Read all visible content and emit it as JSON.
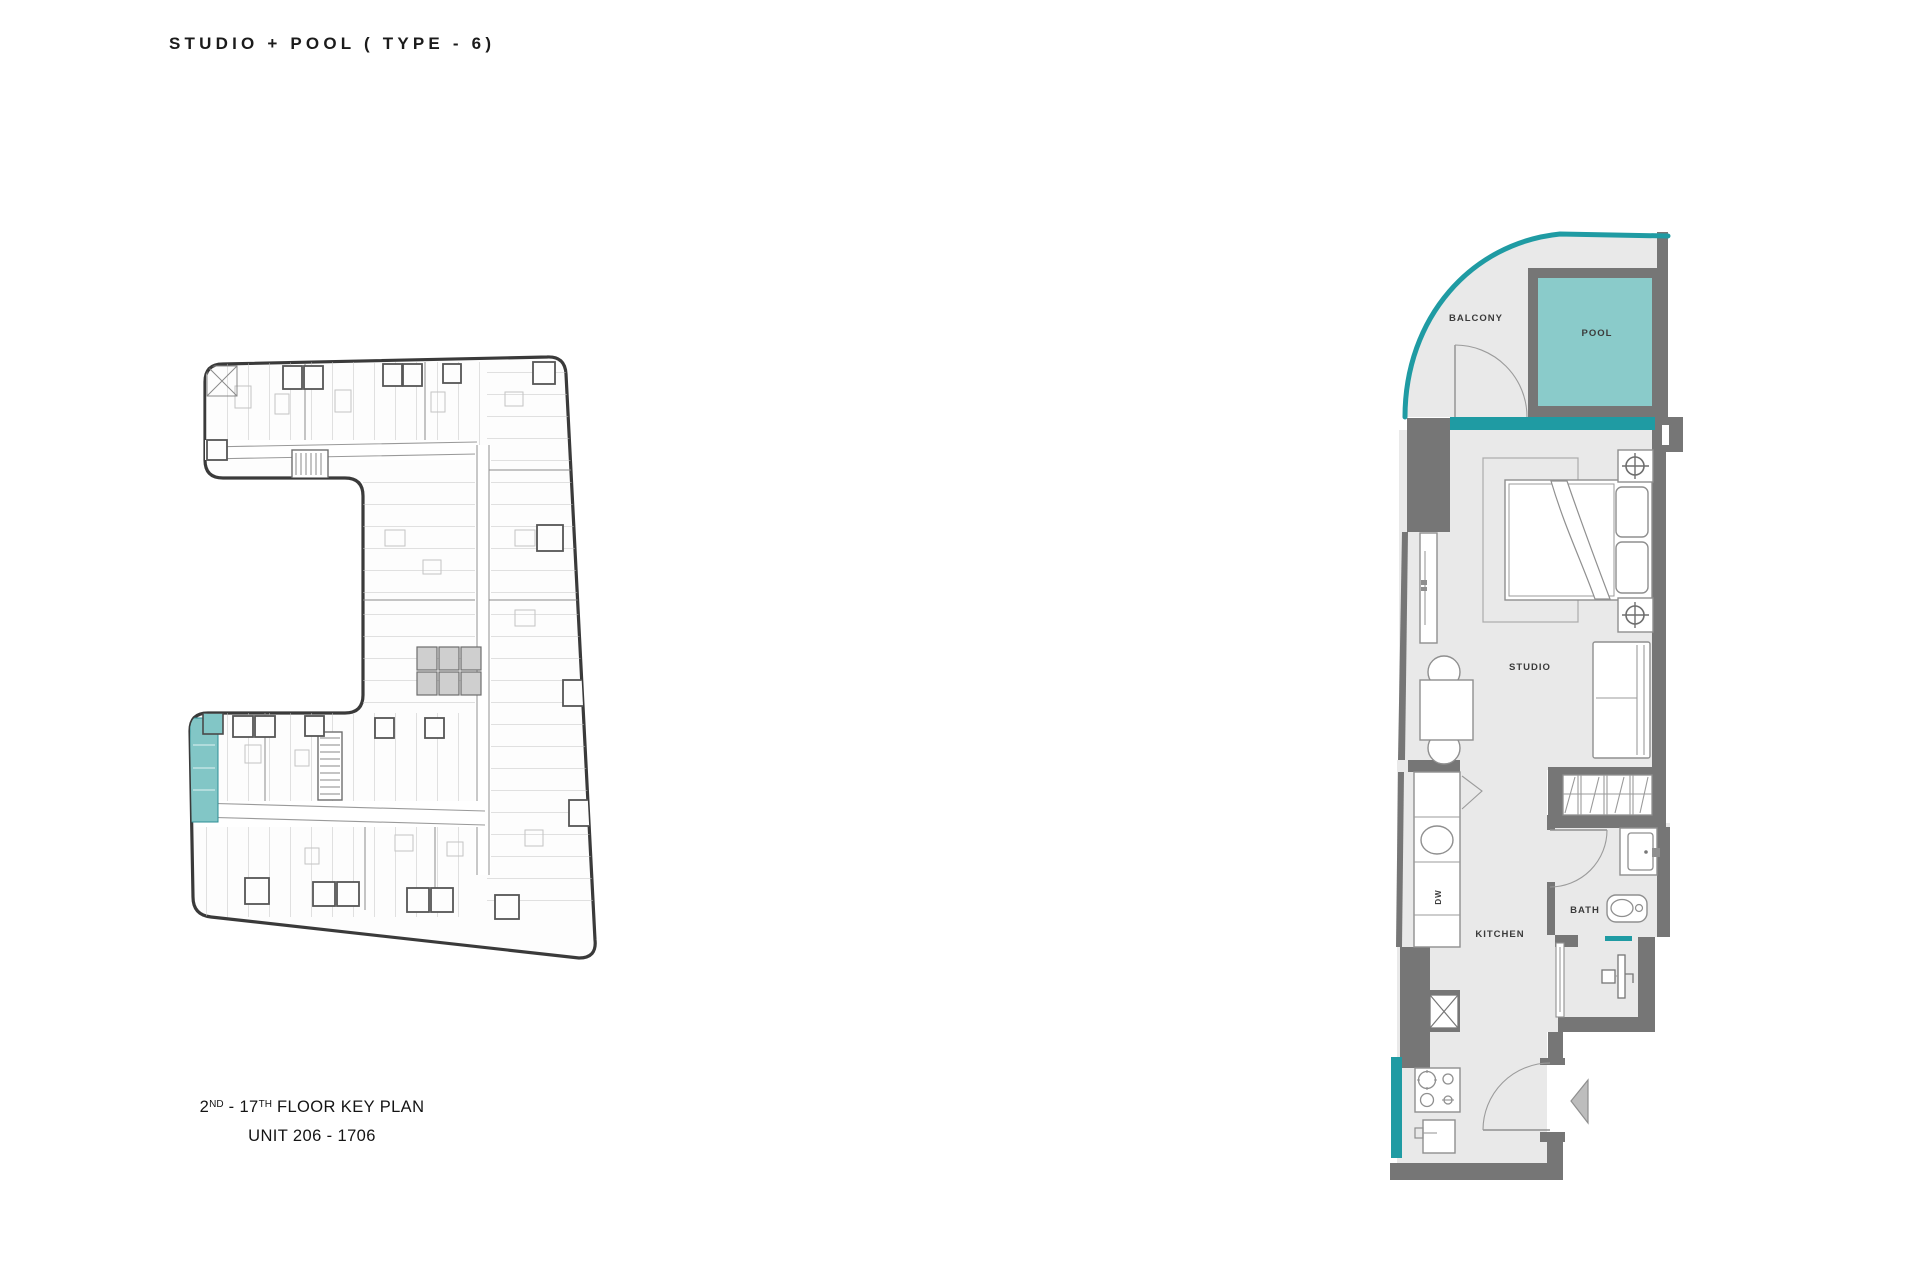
{
  "title": "STUDIO + POOL ( TYPE - 6)",
  "key_plan": {
    "caption_line1": {
      "p1": "2",
      "sup1": "ND",
      "p2": " - 17",
      "sup2": "TH",
      "p3": " FLOOR KEY PLAN"
    },
    "caption_line2": "UNIT 206 - 1706",
    "highlight_color": "#82c6c6"
  },
  "unit_plan": {
    "labels": {
      "balcony": "BALCONY",
      "pool": "POOL",
      "studio": "STUDIO",
      "kitchen": "KITCHEN",
      "bath": "BATH",
      "dishwasher": "DW"
    },
    "colors": {
      "teal_accent": "#1f9ba3",
      "pool_fill": "#8acbca",
      "wall": "#767676",
      "floor": "#e9e9e9"
    }
  }
}
